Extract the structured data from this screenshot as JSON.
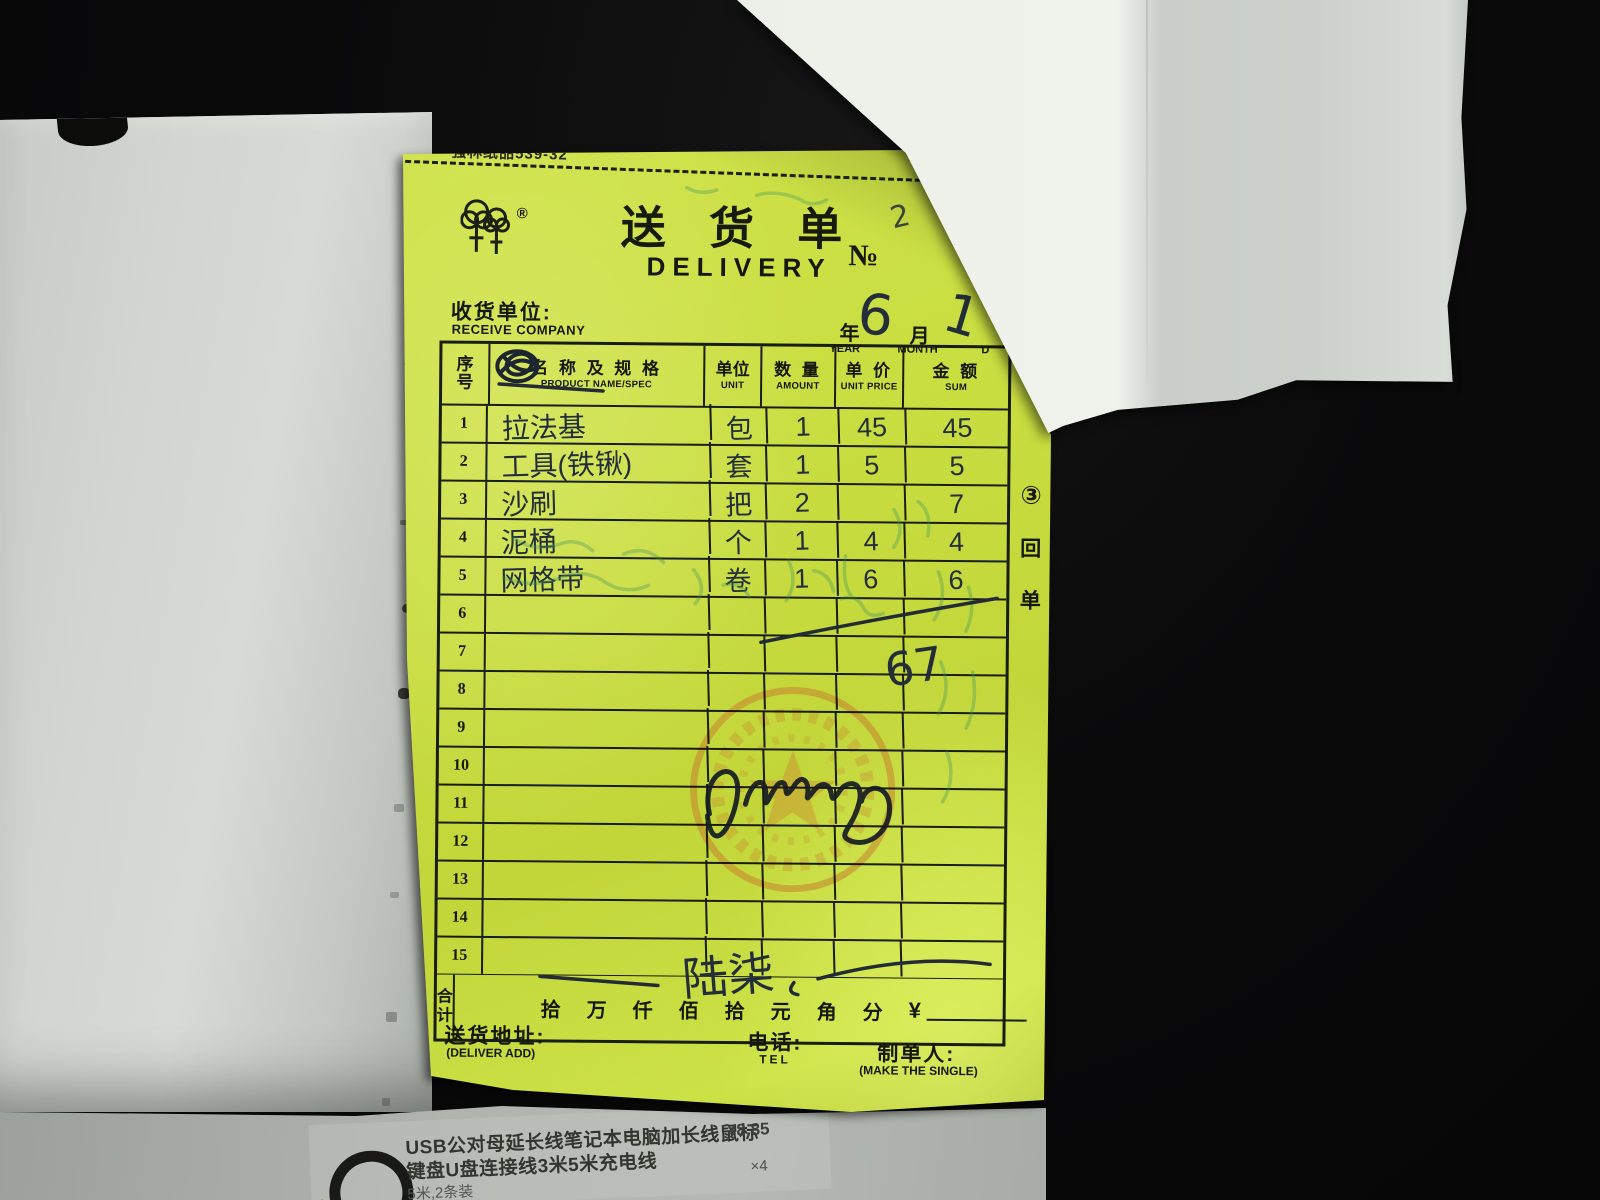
{
  "form": {
    "paper_code": "强林纸品539-32",
    "logo_icon": "double-tree-logo",
    "logo_registered": "®",
    "title_cn": "送 货 单",
    "title_en": "DELIVERY",
    "no_label": "№",
    "no_handwritten": "2",
    "receiver_label_cn": "收货单位:",
    "receiver_label_en": "RECEIVE COMPANY",
    "date": {
      "year_label_cn": "年",
      "year_label_en": "YEAR",
      "month_label_cn": "月",
      "month_label_en": "MONTH",
      "day_label_en": "D",
      "month_value": "6",
      "day_value": "1"
    },
    "table": {
      "headers": {
        "no_cn1": "序",
        "no_cn2": "号",
        "name_cn": "名 称 及 规 格",
        "name_en": "PRODUCT NAME/SPEC",
        "unit_cn": "单位",
        "unit_en": "UNIT",
        "amount_cn": "数 量",
        "amount_en": "AMOUNT",
        "price_cn": "单 价",
        "price_en": "UNIT PRICE",
        "sum_cn": "金 额",
        "sum_en": "SUM"
      },
      "rows": [
        {
          "no": "1",
          "name": "拉法基",
          "unit": "包",
          "amount": "1",
          "price": "45",
          "sum": "45"
        },
        {
          "no": "2",
          "name": "工具(铁锹)",
          "unit": "套",
          "amount": "1",
          "price": "5",
          "sum": "5"
        },
        {
          "no": "3",
          "name": "沙刷",
          "unit": "把",
          "amount": "2",
          "price": "",
          "sum": "7"
        },
        {
          "no": "4",
          "name": "泥桶",
          "unit": "个",
          "amount": "1",
          "price": "4",
          "sum": "4"
        },
        {
          "no": "5",
          "name": "网格带",
          "unit": "卷",
          "amount": "1",
          "price": "6",
          "sum": "6"
        },
        {
          "no": "6",
          "name": "",
          "unit": "",
          "amount": "",
          "price": "",
          "sum": ""
        },
        {
          "no": "7",
          "name": "",
          "unit": "",
          "amount": "",
          "price": "",
          "sum": ""
        },
        {
          "no": "8",
          "name": "",
          "unit": "",
          "amount": "",
          "price": "",
          "sum": ""
        },
        {
          "no": "9",
          "name": "",
          "unit": "",
          "amount": "",
          "price": "",
          "sum": ""
        },
        {
          "no": "10",
          "name": "",
          "unit": "",
          "amount": "",
          "price": "",
          "sum": ""
        },
        {
          "no": "11",
          "name": "",
          "unit": "",
          "amount": "",
          "price": "",
          "sum": ""
        },
        {
          "no": "12",
          "name": "",
          "unit": "",
          "amount": "",
          "price": "",
          "sum": ""
        },
        {
          "no": "13",
          "name": "",
          "unit": "",
          "amount": "",
          "price": "",
          "sum": ""
        },
        {
          "no": "14",
          "name": "",
          "unit": "",
          "amount": "",
          "price": "",
          "sum": ""
        },
        {
          "no": "15",
          "name": "",
          "unit": "",
          "amount": "",
          "price": "",
          "sum": ""
        }
      ],
      "grand_total_handwritten": "67"
    },
    "total_row": {
      "label_cn1": "合",
      "label_cn2": "计",
      "units_cn": [
        "拾",
        "万",
        "仟",
        "佰",
        "拾",
        "元",
        "角",
        "分"
      ],
      "currency": "¥",
      "amount_handwritten_cn": "陆柒"
    },
    "copy_mark": {
      "num": "③",
      "chars": [
        "回",
        "单"
      ]
    },
    "stamp_icon": "round-red-star-seal",
    "signature_icon": "handwritten-signature",
    "footer": {
      "address_cn": "送货地址:",
      "address_en": "(DELIVER ADD)",
      "tel_cn": "电话:",
      "tel_en": "TEL",
      "maker_cn": "制单人:",
      "maker_en": "(MAKE THE SINGLE)"
    }
  },
  "product_label": {
    "cable_icon": "coiled-cable-photo",
    "line1": "USB公对母延长线笔记本电脑加长线鼠标",
    "line2": "键盘U盘连接线3米5米充电线",
    "line3": "5米,2条装",
    "price": "¥8.85",
    "quantity": "×4"
  },
  "colors": {
    "sheet_green": "#c9de41",
    "ink_print": "#15180e",
    "ink_pen": "#242e3a",
    "stamp_orange": "#c6792b",
    "bleed_teal": "#3f8f5f",
    "background": "#0a0a0b"
  }
}
